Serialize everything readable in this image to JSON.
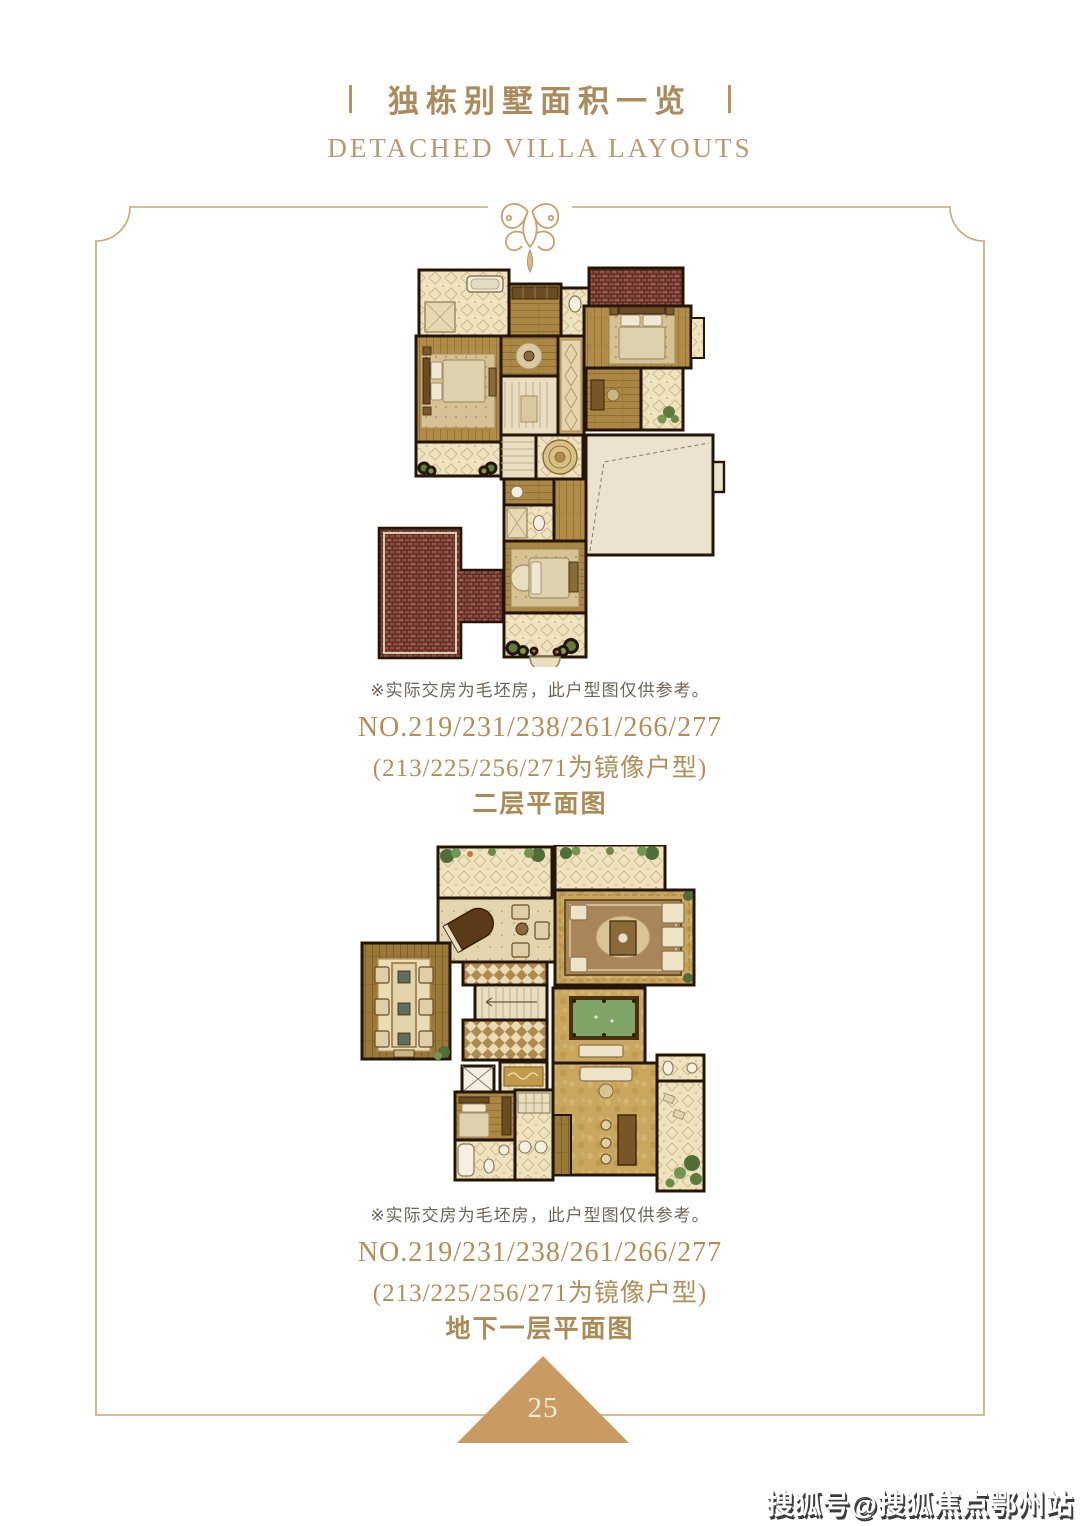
{
  "page": {
    "title_zh": "独栋别墅面积一览",
    "title_en": "DETACHED VILLA LAYOUTS",
    "page_number": "25",
    "watermark": "搜狐号@搜狐焦点鄂州站"
  },
  "plans": [
    {
      "name": "second-floor-plan",
      "disclaimer": "※实际交房为毛坯房，此户型图仅供参考。",
      "unit_numbers": "NO.219/231/238/261/266/277",
      "mirror_note": "(213/225/256/271为镜像户型)",
      "floor_label": "二层平面图"
    },
    {
      "name": "basement-floor-plan",
      "disclaimer": "※实际交房为毛坯房，此户型图仅供参考。",
      "unit_numbers": "NO.219/231/238/261/266/277",
      "mirror_note": "(213/225/256/271为镜像户型)",
      "floor_label": "地下一层平面图"
    }
  ],
  "colors": {
    "accent_gold": "#ab8a5c",
    "frame_line": "#c6a872",
    "triangle": "#c99b63",
    "disclaimer_text": "#6f6459",
    "wall": "#241607"
  }
}
